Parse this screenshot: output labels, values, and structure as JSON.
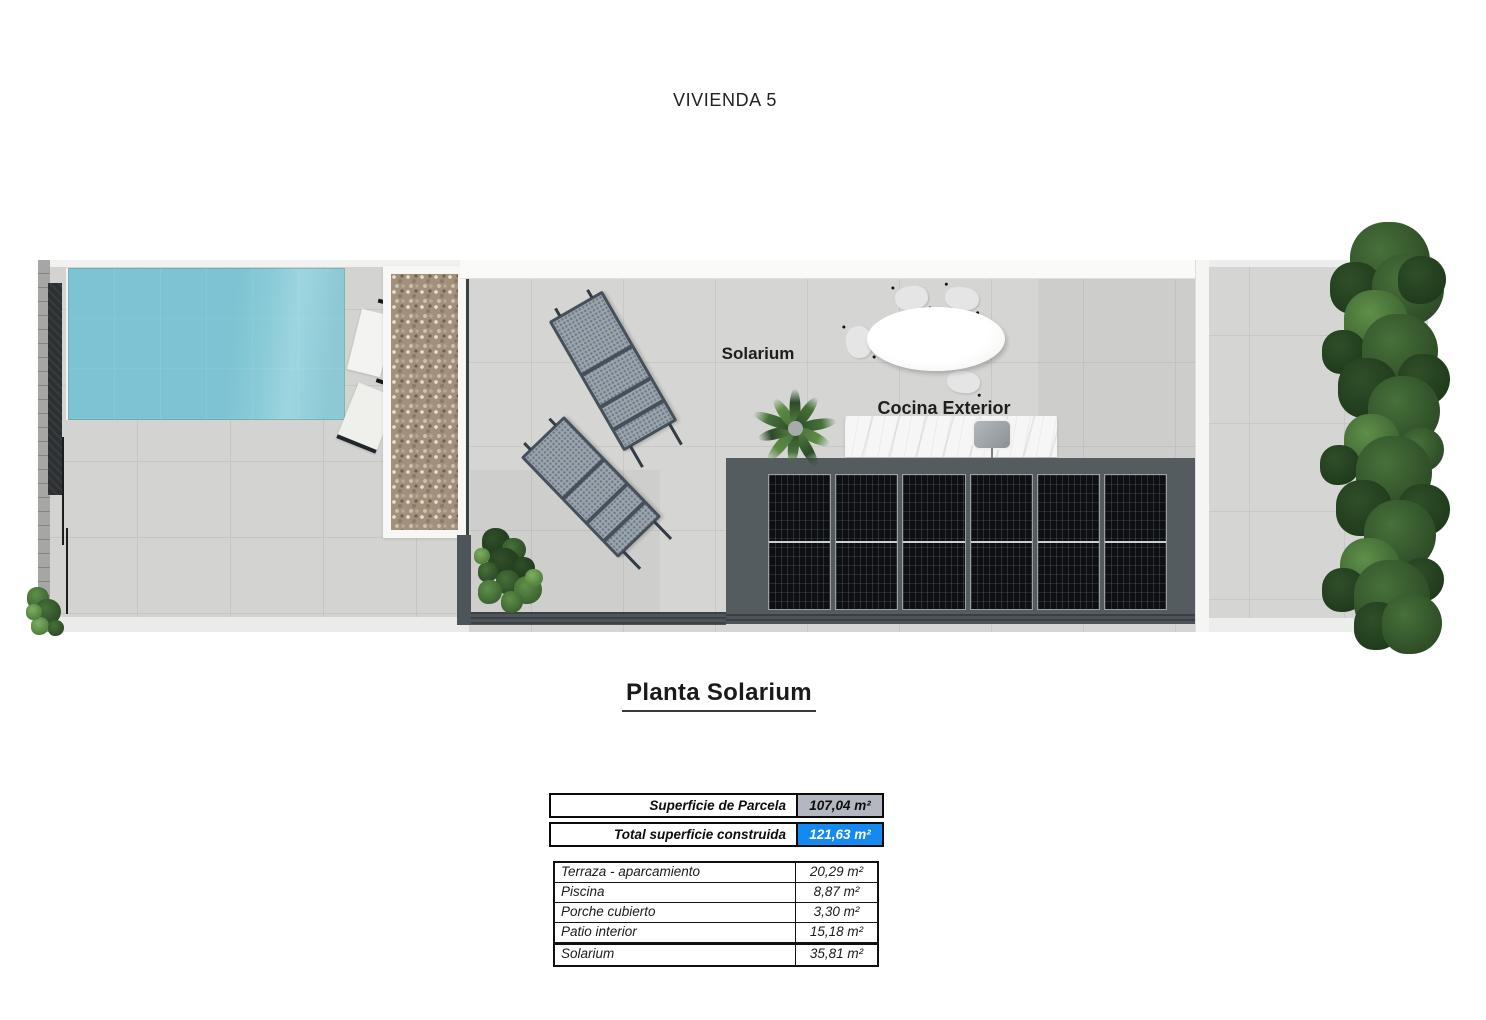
{
  "title": "VIVIENDA 5",
  "heading": "Planta Solarium",
  "plan": {
    "label_solarium": "Solarium",
    "label_cocina": "Cocina Exterior"
  },
  "summary": {
    "rows": [
      {
        "label": "Superficie de Parcela",
        "value": "107,04 m²",
        "highlight": "#b3b8c0"
      },
      {
        "label": "Total superficie  construida",
        "value": "121,63 m²",
        "highlight": "#1489f2"
      }
    ]
  },
  "areas": {
    "rows": [
      {
        "label": "Terraza - aparcamiento",
        "value": "20,29 m²"
      },
      {
        "label": "Piscina",
        "value": "8,87 m²"
      },
      {
        "label": "Porche cubierto",
        "value": "3,30 m²"
      },
      {
        "label": "Patio interior",
        "value": "15,18 m²"
      }
    ],
    "solarium_row": {
      "label": "Solarium",
      "value": "35,81 m²"
    }
  },
  "colors": {
    "pool": "#7ec3d3",
    "slab": "#545c5f",
    "solar_panel": "#0d0f13",
    "foliage": "#37582c",
    "highlight_gray": "#b3b8c0",
    "highlight_blue": "#1489f2"
  }
}
